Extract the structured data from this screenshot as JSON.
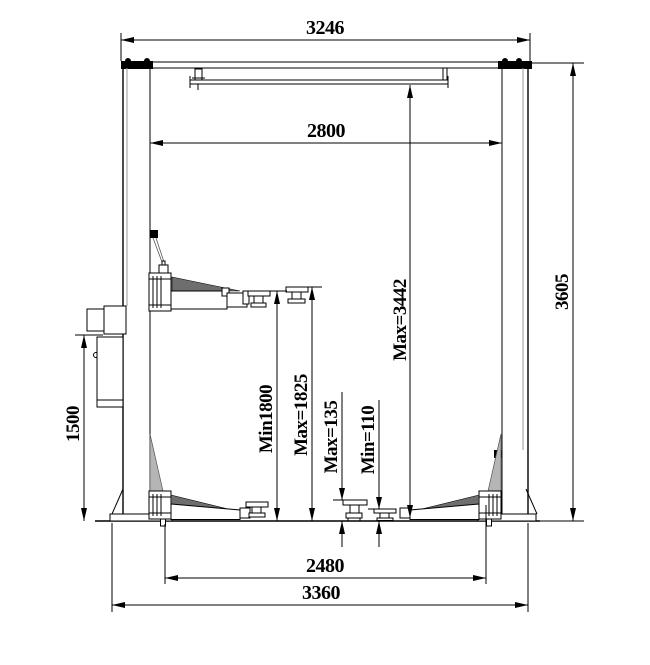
{
  "diagram": {
    "title": "two-post-lift-dimension-drawing",
    "dimensions": {
      "top_beam_width": "3246",
      "clear_width_between_posts": "2800",
      "overall_height": "3605",
      "max_height_under_beam": "Max=3442",
      "min_pad_rise": "Min1800",
      "max_pad_rise": "Max=1825",
      "pad_height_max": "Max=135",
      "pad_height_min": "Min=110",
      "power_unit_height": "1500",
      "inner_base_span": "2480",
      "outer_base_span": "3360"
    }
  }
}
